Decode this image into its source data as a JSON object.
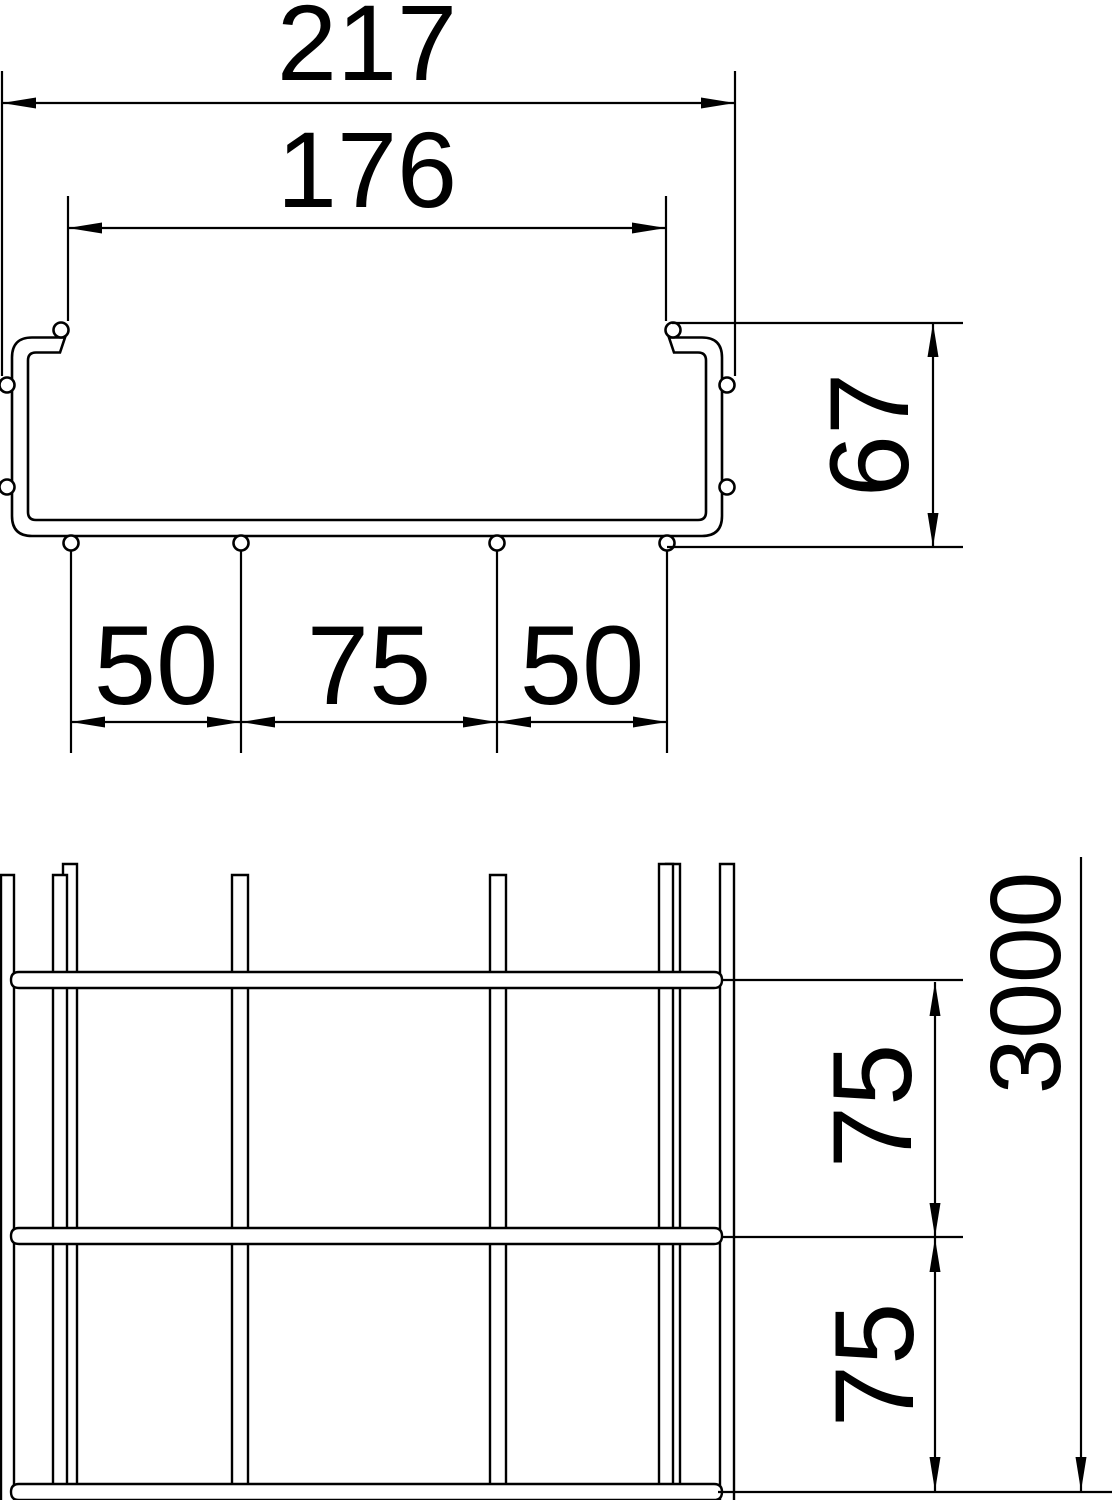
{
  "drawing": {
    "kind": "dimensioned-technical-drawing",
    "subject": "wire-mesh-cable-tray",
    "colors": {
      "line": "#000000",
      "background": "#ffffff"
    },
    "views": {
      "cross_section": {
        "name": "cross-section-view",
        "dims": {
          "outer_width": "217",
          "inner_width": "176",
          "height": "67",
          "bottom_left": "50",
          "bottom_center": "75",
          "bottom_right": "50"
        }
      },
      "top_view": {
        "name": "length-view",
        "dims": {
          "pitch_a": "75",
          "pitch_b": "75",
          "length": "3000"
        }
      }
    }
  }
}
